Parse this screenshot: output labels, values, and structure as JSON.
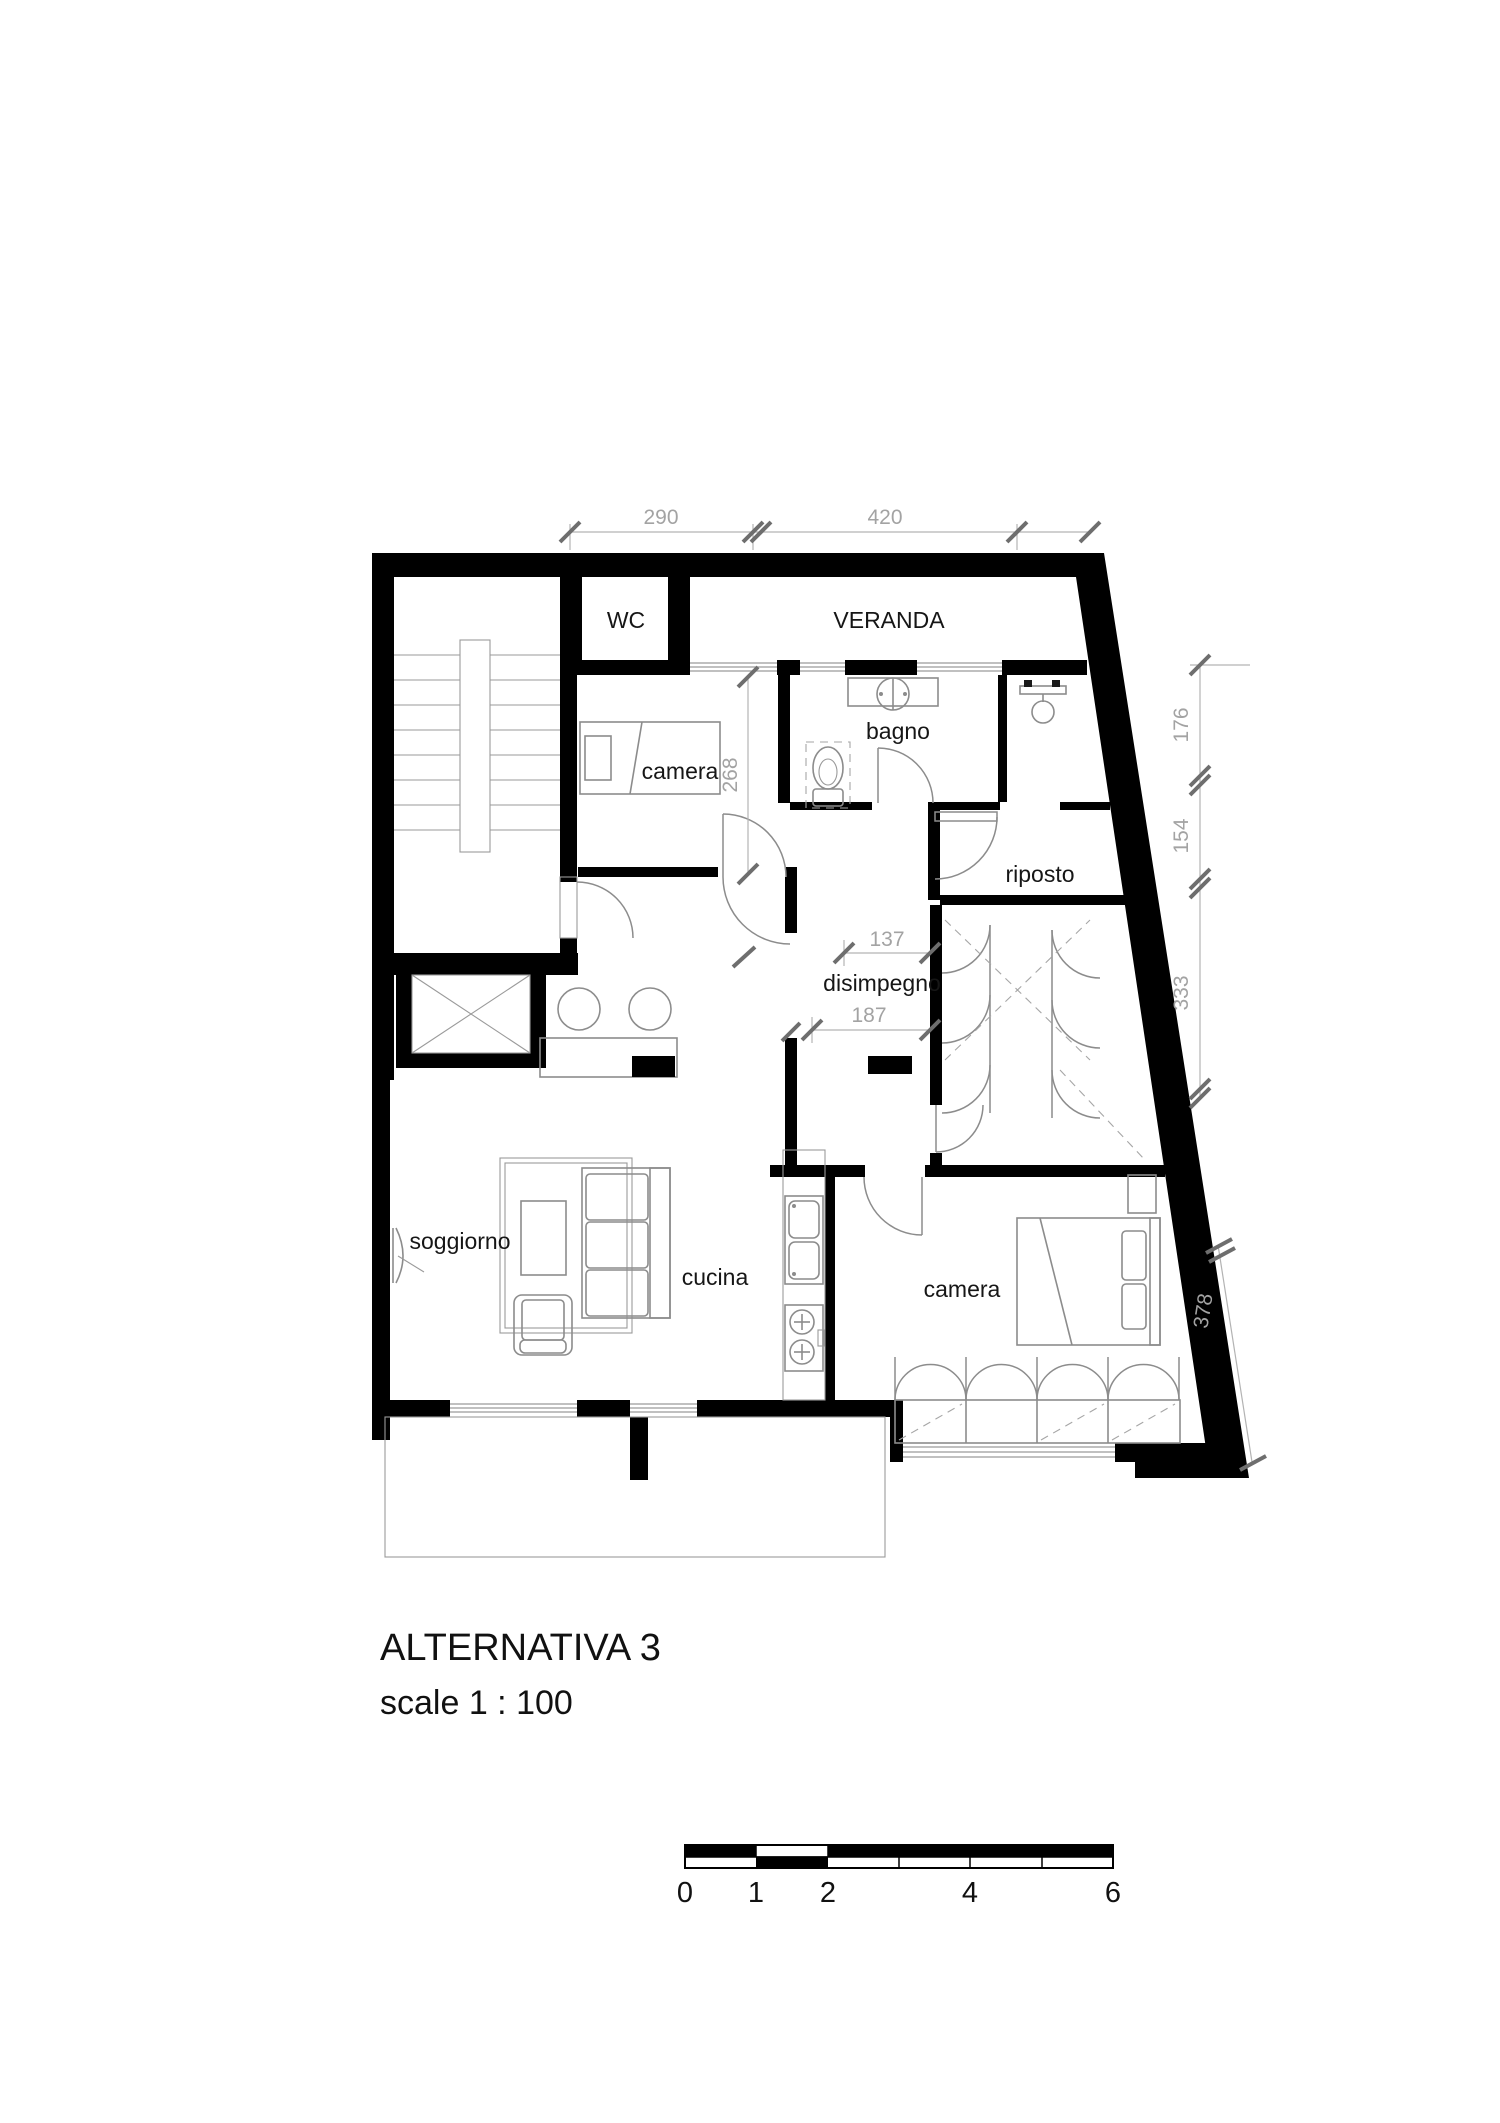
{
  "drawing": {
    "title": "ALTERNATIVA 3",
    "scale_note": "scale 1 : 100",
    "rooms": {
      "wc": "WC",
      "veranda": "VERANDA",
      "bagno": "bagno",
      "camera_top": "camera",
      "riposto": "riposto",
      "disimpegno": "disimpegno",
      "soggiorno": "soggiorno",
      "cucina": "cucina",
      "camera_bottom": "camera"
    },
    "dimensions_cm": {
      "top_left": "290",
      "top_right": "420",
      "camera_top_depth": "268",
      "right_upper": "176",
      "right_middle": "154",
      "right_lower": "333",
      "disimpegno_upper": "137",
      "disimpegno_lower": "187",
      "camera_bottom_side": "378"
    },
    "scale_bar": {
      "labels": [
        "0",
        "1",
        "2",
        "4",
        "6"
      ]
    },
    "colors": {
      "walls": "#000000",
      "furniture_lines": "#8c8c8c",
      "dimension_text": "#a3a3a3",
      "dimension_ticks": "#6e6e6e",
      "background": "#ffffff"
    }
  }
}
